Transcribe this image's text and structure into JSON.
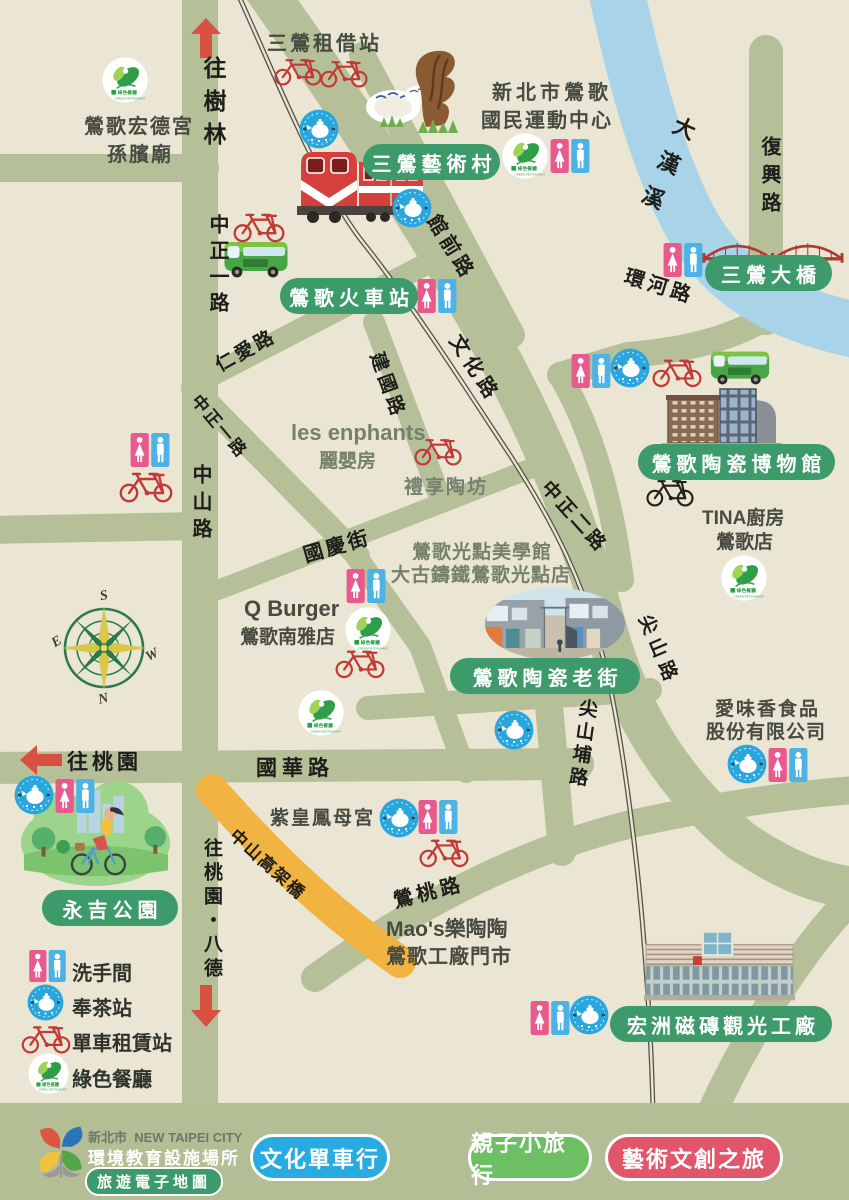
{
  "pills": [
    {
      "text": "三鶯藝術村"
    },
    {
      "text": "鶯歌火車站"
    },
    {
      "text": "三鶯大橋"
    },
    {
      "text": "鶯歌陶瓷博物館"
    },
    {
      "text": "鶯歌陶瓷老街"
    },
    {
      "text": "永吉公園"
    },
    {
      "text": "宏洲磁磚觀光工廠"
    }
  ],
  "roads": [
    {
      "text": "往樹林"
    },
    {
      "text": "中正一路"
    },
    {
      "text": "仁愛路"
    },
    {
      "text": "中正一路"
    },
    {
      "text": "中山路"
    },
    {
      "text": "國慶街"
    },
    {
      "text": "建國路"
    },
    {
      "text": "館前路"
    },
    {
      "text": "文化路"
    },
    {
      "text": "中正二路"
    },
    {
      "text": "環河路"
    },
    {
      "text": "復興路"
    },
    {
      "text": "尖山路"
    },
    {
      "text": "尖山埔路"
    },
    {
      "text": "國華路"
    },
    {
      "text": "往桃園"
    },
    {
      "text": "往桃園・八德"
    },
    {
      "text": "鶯桃路"
    },
    {
      "text": "中山高架橋"
    },
    {
      "text": "大漢溪"
    }
  ],
  "pois": [
    {
      "text": "三鶯租借站"
    },
    {
      "text": "鶯歌宏德宮"
    },
    {
      "text": "孫臏廟"
    },
    {
      "text": "新北市鶯歌"
    },
    {
      "text": "國民運動中心"
    },
    {
      "text": "les enphants"
    },
    {
      "text": "麗嬰房"
    },
    {
      "text": "禮享陶坊"
    },
    {
      "text": "鶯歌光點美學館"
    },
    {
      "text": "大古鑄鐵鶯歌光點店"
    },
    {
      "text": "Q Burger"
    },
    {
      "text": "鶯歌南雅店"
    },
    {
      "text": "TINA廚房"
    },
    {
      "text": "鶯歌店"
    },
    {
      "text": "愛味香食品"
    },
    {
      "text": "股份有限公司"
    },
    {
      "text": "紫皇鳳母宮"
    },
    {
      "text": "Mao's樂陶陶"
    },
    {
      "text": "鶯歌工廠門市"
    }
  ],
  "compass": {
    "n": "N",
    "s": "S",
    "e": "E",
    "w": "W"
  },
  "legend": {
    "items": [
      {
        "icon": "toilet-icon",
        "label": "洗手間"
      },
      {
        "icon": "tea-station-icon",
        "label": "奉茶站"
      },
      {
        "icon": "bike-rental-icon",
        "label": "單車租賃站"
      },
      {
        "icon": "green-restaurant-icon",
        "label": "綠色餐廳"
      }
    ]
  },
  "footer": {
    "city": "新北市",
    "city_en": "NEW TAIPEI CITY",
    "org": "環境教育設施場所",
    "badge": "旅遊電子地圖",
    "buttons": [
      {
        "label": "文化單車行",
        "color": "#29abe2"
      },
      {
        "label": "親子小旅行",
        "color": "#6cbf63"
      },
      {
        "label": "藝術文創之旅",
        "color": "#e2566b"
      }
    ]
  },
  "colors": {
    "background": "#eae6d3",
    "road": "#b6c098",
    "river": "#a8d3e8",
    "label_green": "#3d9b6b",
    "viaduct_yellow": "#f2b441",
    "arrow_red": "#d8503f",
    "railway": "#56544b"
  }
}
